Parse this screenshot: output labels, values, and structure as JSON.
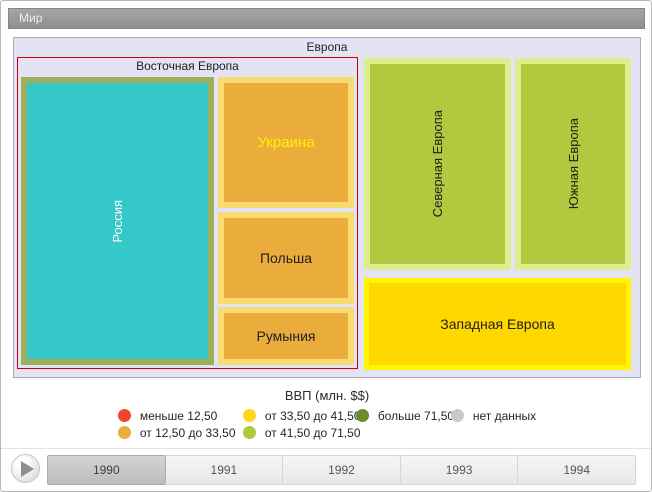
{
  "ui": {
    "header": {
      "title": "Мир"
    },
    "treemap": {
      "europe_label": "Европа",
      "eastern_label": "Восточная Европа",
      "tiles": {
        "russia": {
          "label": "Россия",
          "fill": "#35C8C8",
          "border": "#9DAE5C",
          "text_color": "#FFFFFF"
        },
        "ukraine": {
          "label": "Украина",
          "fill": "#EAAD3C",
          "border": "#F8DC73",
          "text_color": "#FFF000"
        },
        "poland": {
          "label": "Польша",
          "fill": "#EAAD3C",
          "border": "#F8DC73"
        },
        "romania": {
          "label": "Румыния",
          "fill": "#EAAD3C",
          "border": "#F8DC73"
        },
        "northern": {
          "label": "Северная Европа",
          "fill": "#B1C93F",
          "border": "#DCEE8D"
        },
        "southern": {
          "label": "Южная Европа",
          "fill": "#B1C93F",
          "border": "#DCEE8D"
        },
        "western": {
          "label": "Западная Европа",
          "fill": "#FFD800",
          "border": "#FFF500"
        }
      }
    },
    "legend": {
      "title": "ВВП (млн. $$)",
      "items": [
        {
          "label": "меньше 12,50",
          "color": "#F1462F"
        },
        {
          "label": "от 12,50 до 33,50",
          "color": "#EAAD3C"
        },
        {
          "label": "от 33,50 до 41,50",
          "color": "#FFD51E"
        },
        {
          "label": "от 41,50 до 71,50",
          "color": "#B1C93F"
        },
        {
          "label": "больше 71,50",
          "color": "#6F8A2B"
        },
        {
          "label": "нет данных",
          "color": "#C9C9C9"
        }
      ]
    },
    "timeline": {
      "years": [
        "1990",
        "1991",
        "1992",
        "1993",
        "1994"
      ],
      "selected": "1990"
    }
  },
  "chart_data": {
    "type": "treemap",
    "title": "Мир",
    "root": "Европа",
    "legend_title": "ВВП (млн. $$)",
    "legend_bins": [
      {
        "label": "меньше 12,50",
        "color": "#F1462F"
      },
      {
        "label": "от 12,50 до 33,50",
        "color": "#EAAD3C"
      },
      {
        "label": "от 33,50 до 41,50",
        "color": "#FFD51E"
      },
      {
        "label": "от 41,50 до 71,50",
        "color": "#B1C93F"
      },
      {
        "label": "больше 71,50",
        "color": "#6F8A2B"
      },
      {
        "label": "нет данных",
        "color": "#C9C9C9"
      }
    ],
    "nodes": [
      {
        "name": "Россия",
        "group": "Восточная Европа",
        "tile_color": "#35C8C8",
        "note": "highlighted tile"
      },
      {
        "name": "Украина",
        "group": "Восточная Европа",
        "tile_color": "#EAAD3C",
        "bin": "от 12,50 до 33,50"
      },
      {
        "name": "Польша",
        "group": "Восточная Европа",
        "tile_color": "#EAAD3C",
        "bin": "от 12,50 до 33,50"
      },
      {
        "name": "Румыния",
        "group": "Восточная Европа",
        "tile_color": "#EAAD3C",
        "bin": "от 12,50 до 33,50"
      },
      {
        "name": "Северная Европа",
        "group": "Европа",
        "tile_color": "#B1C93F",
        "bin": "от 41,50 до 71,50"
      },
      {
        "name": "Южная Европа",
        "group": "Европа",
        "tile_color": "#B1C93F",
        "bin": "от 41,50 до 71,50"
      },
      {
        "name": "Западная Европа",
        "group": "Европа",
        "tile_color": "#FFD800",
        "bin": "от 33,50 до 41,50"
      }
    ],
    "timeline": {
      "years": [
        "1990",
        "1991",
        "1992",
        "1993",
        "1994"
      ],
      "selected": "1990"
    }
  }
}
